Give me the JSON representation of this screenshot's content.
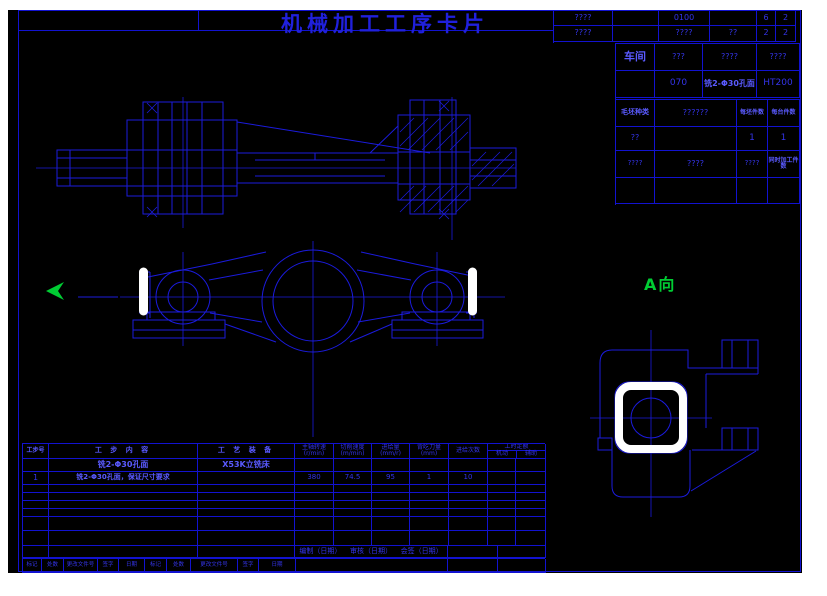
{
  "title": "机械加工工序卡片",
  "top_strip": {
    "r1": [
      "????",
      "",
      "0100",
      "",
      "6",
      "2"
    ],
    "r2": [
      "????",
      "",
      "????",
      "??",
      "2",
      "2"
    ]
  },
  "info_table": {
    "r1": {
      "label": "车间",
      "c2": "???",
      "c3": "????",
      "c4": "????"
    },
    "r2": {
      "op_no": "070",
      "op_name": "铣2-Φ30孔面",
      "material": "HT200"
    },
    "r3": {
      "label": "毛坯种类",
      "value": "??????",
      "per_blank": "每坯件数",
      "per_unit": "每台件数"
    },
    "r4": {
      "c1": "??",
      "per_blank": "1",
      "per_unit": "1"
    },
    "r5": {
      "c1": "????",
      "c2": "????",
      "c3": "????",
      "simul": "同时加工件数"
    }
  },
  "views": {
    "direction_label": "A向"
  },
  "process_table": {
    "headers": {
      "step_no": "工步号",
      "content": "工 步 内 容",
      "equipment": "工 艺 装 备",
      "spindle1": "主轴转速",
      "spindle2": "(r/min)",
      "speed1": "切削速度",
      "speed2": "(m/min)",
      "feed1": "进给量",
      "feed2": "(mm/r)",
      "depth1": "背吃刀量",
      "depth2": "(mm)",
      "passes": "进给次数",
      "time": "工时定额",
      "time_m": "机动",
      "time_a": "辅助"
    },
    "row1": {
      "content": "铣2-Φ30孔面",
      "equipment": "X53K立铣床"
    },
    "row2": {
      "no": "1",
      "content": "铣2-Φ30孔面，保证尺寸要求",
      "spindle": "380",
      "speed": "74.5",
      "feed": "95",
      "depth": "1",
      "passes": "10"
    },
    "footer": {
      "prepare": "编制（日期）",
      "audit": "审核（日期）",
      "countersign": "会签（日期）"
    },
    "strip": [
      "标记",
      "处数",
      "更改文件号",
      "签字",
      "日期",
      "标记",
      "处数",
      "更改文件号",
      "签字",
      "日期"
    ]
  }
}
